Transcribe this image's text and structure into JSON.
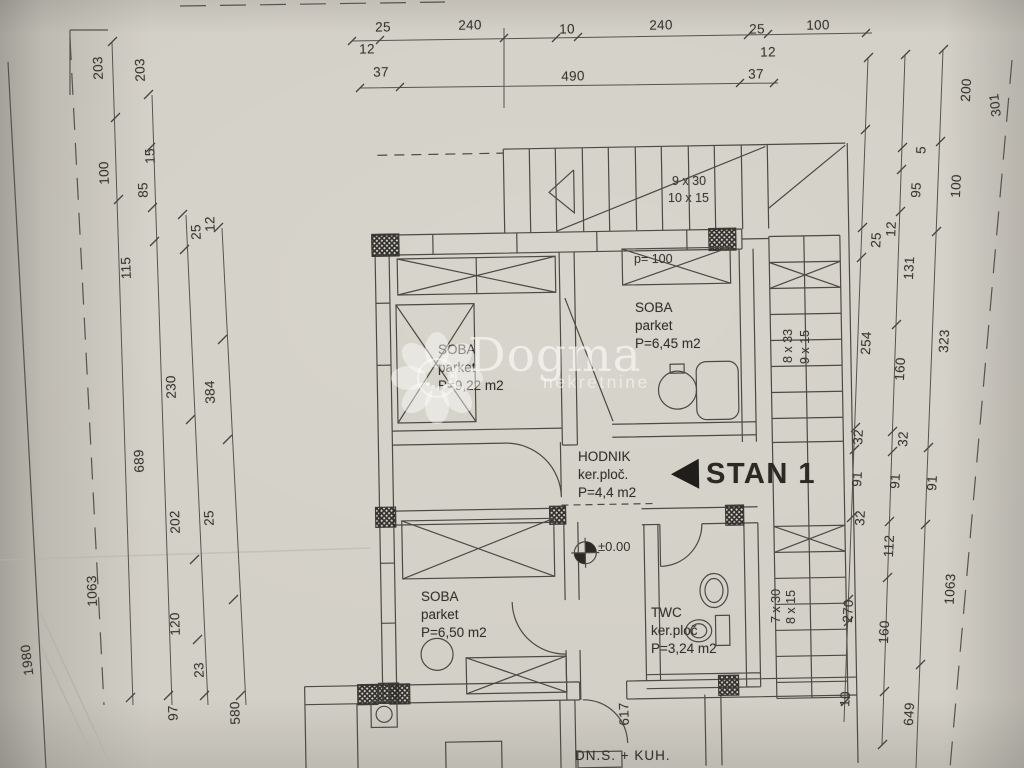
{
  "watermark": {
    "brand": "Dogma",
    "subtitle": "nekretnine"
  },
  "markers": {
    "unit": "STAN 1",
    "level": "±0.00"
  },
  "rooms": {
    "soba1": {
      "name": "SOBA",
      "floor": "parket",
      "area": "P=9,22 m2"
    },
    "soba2": {
      "name": "SOBA",
      "floor": "parket",
      "area": "P=6,45 m2"
    },
    "soba3": {
      "name": "SOBA",
      "floor": "parket",
      "area": "P=6,50 m2"
    },
    "hodnik": {
      "name": "HODNIK",
      "floor": "ker.ploč.",
      "area": "P=4,4 m2"
    },
    "twc": {
      "name": "TWC",
      "floor": "ker.ploč",
      "area": "P=3,24 m2"
    },
    "dns": {
      "name": "DN.S. + KUH."
    }
  },
  "stairs": {
    "top": {
      "r1": "9 x 30",
      "r2": "10 x 15"
    },
    "right_upper": {
      "r1": "8 x 33",
      "r2": "9 x 15"
    },
    "right_lower": {
      "r1": "7 x 30",
      "r2": "8 x 15"
    },
    "parapet": "p= 100"
  },
  "dimensions": {
    "top1": [
      "25",
      "240",
      "10",
      "240",
      "25",
      "100"
    ],
    "top1b": [
      "12",
      "12"
    ],
    "top2": [
      "37",
      "490",
      "37"
    ],
    "left": [
      "203",
      "203",
      "100",
      "15",
      "85",
      "25",
      "12",
      "115",
      "230",
      "384",
      "689",
      "202",
      "25",
      "1063",
      "120",
      "23",
      "97",
      "580"
    ],
    "left_edge": [
      "1980"
    ],
    "right": [
      "200",
      "301",
      "5",
      "95",
      "100",
      "25",
      "12",
      "131",
      "254",
      "160",
      "323",
      "32",
      "32",
      "91",
      "91",
      "91",
      "32",
      "112",
      "1063",
      "270",
      "160",
      "10",
      "649"
    ],
    "bottom": [
      "617"
    ]
  }
}
